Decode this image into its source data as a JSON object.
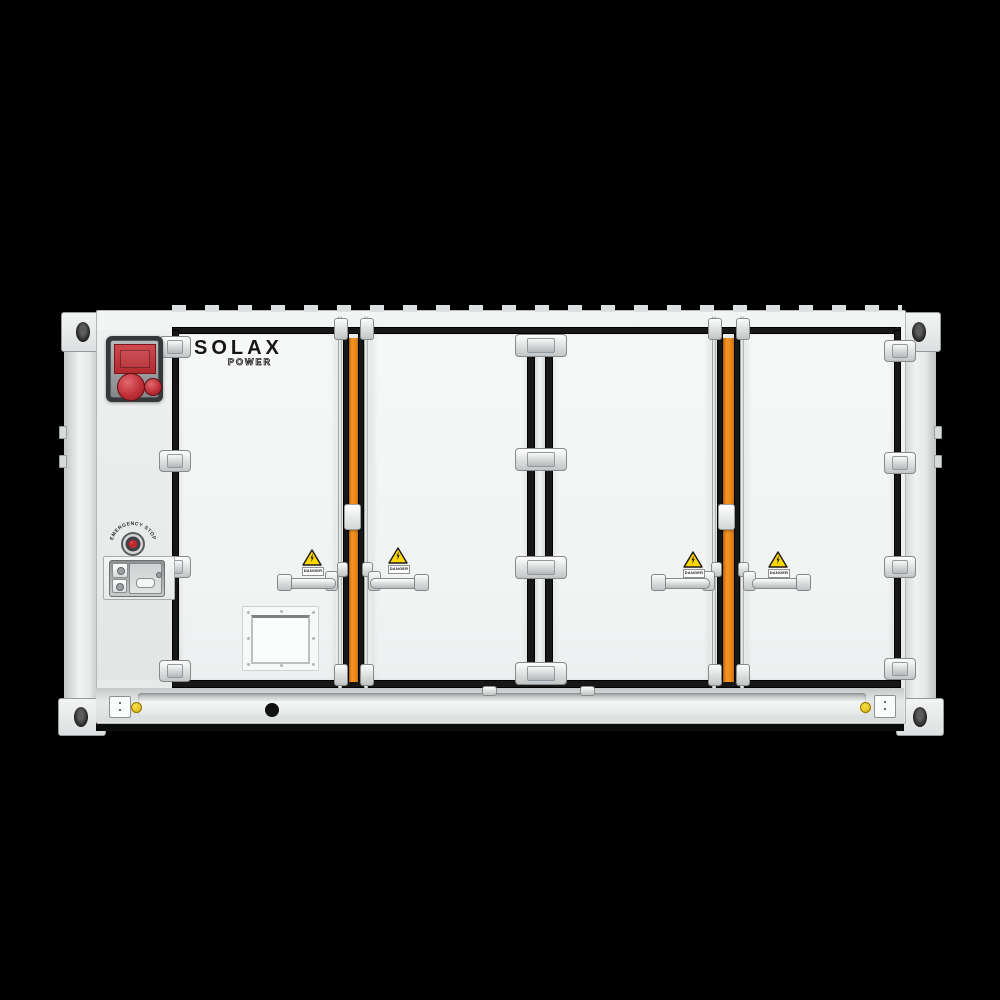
{
  "product": {
    "type": "containerized battery energy storage cabinet",
    "brand": {
      "name": "SOLAX",
      "sub": "POWER"
    },
    "estop": {
      "label": "EMERGENCY STOP"
    },
    "warnings": [
      {
        "label": "DANGER"
      },
      {
        "label": "DANGER"
      },
      {
        "label": "DANGER"
      },
      {
        "label": "DANGER"
      }
    ],
    "colors": {
      "background": "#000000",
      "body": "#eef0f0",
      "door": "#f3f5f5",
      "gasket": "#171717",
      "lock_rod_orange": "#ee8a1a",
      "alarm_red": "#c03439",
      "warning_yellow": "#ffd800",
      "ground_label_yellow": "#e2bd14"
    },
    "icons": {
      "warning_triangle": "warning-triangle-icon",
      "lightning_bolt": "lightning-bolt-icon",
      "emergency_stop": "emergency-stop-button",
      "ground_point": "ground-point-icon"
    }
  }
}
